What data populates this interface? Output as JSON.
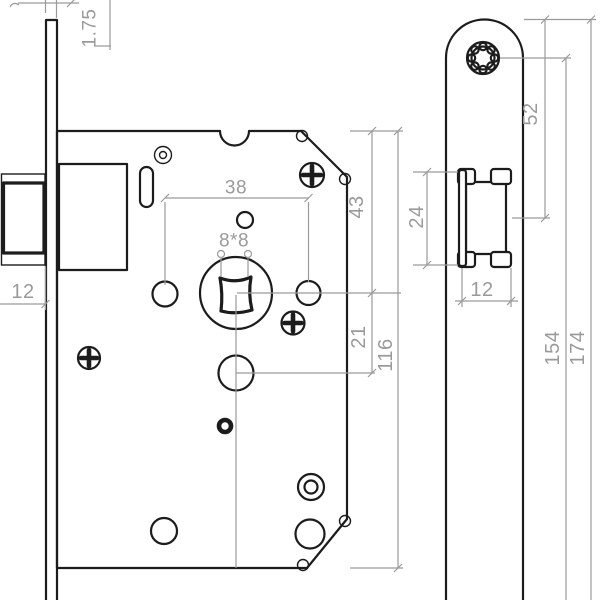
{
  "drawing": {
    "type": "technical-drawing",
    "subject": "mortise door lock, front and side view",
    "colors": {
      "background": "#ffffff",
      "line": "#1c1c1c",
      "dimension": "#9a9a9a"
    },
    "front_view": {
      "dims": {
        "faceplate_thickness": "1.75",
        "latch_protrusion": "12",
        "follower_spacing": "38",
        "spindle_square": "8*8",
        "top_to_spindle": "43",
        "spindle_to_cylinder": "21",
        "body_height": "116"
      }
    },
    "side_view": {
      "dims": {
        "latch_height": "24",
        "latch_depth": "12",
        "top_to_latch_center": "52",
        "screw_spacing": "154",
        "faceplate_length": "174"
      }
    }
  }
}
